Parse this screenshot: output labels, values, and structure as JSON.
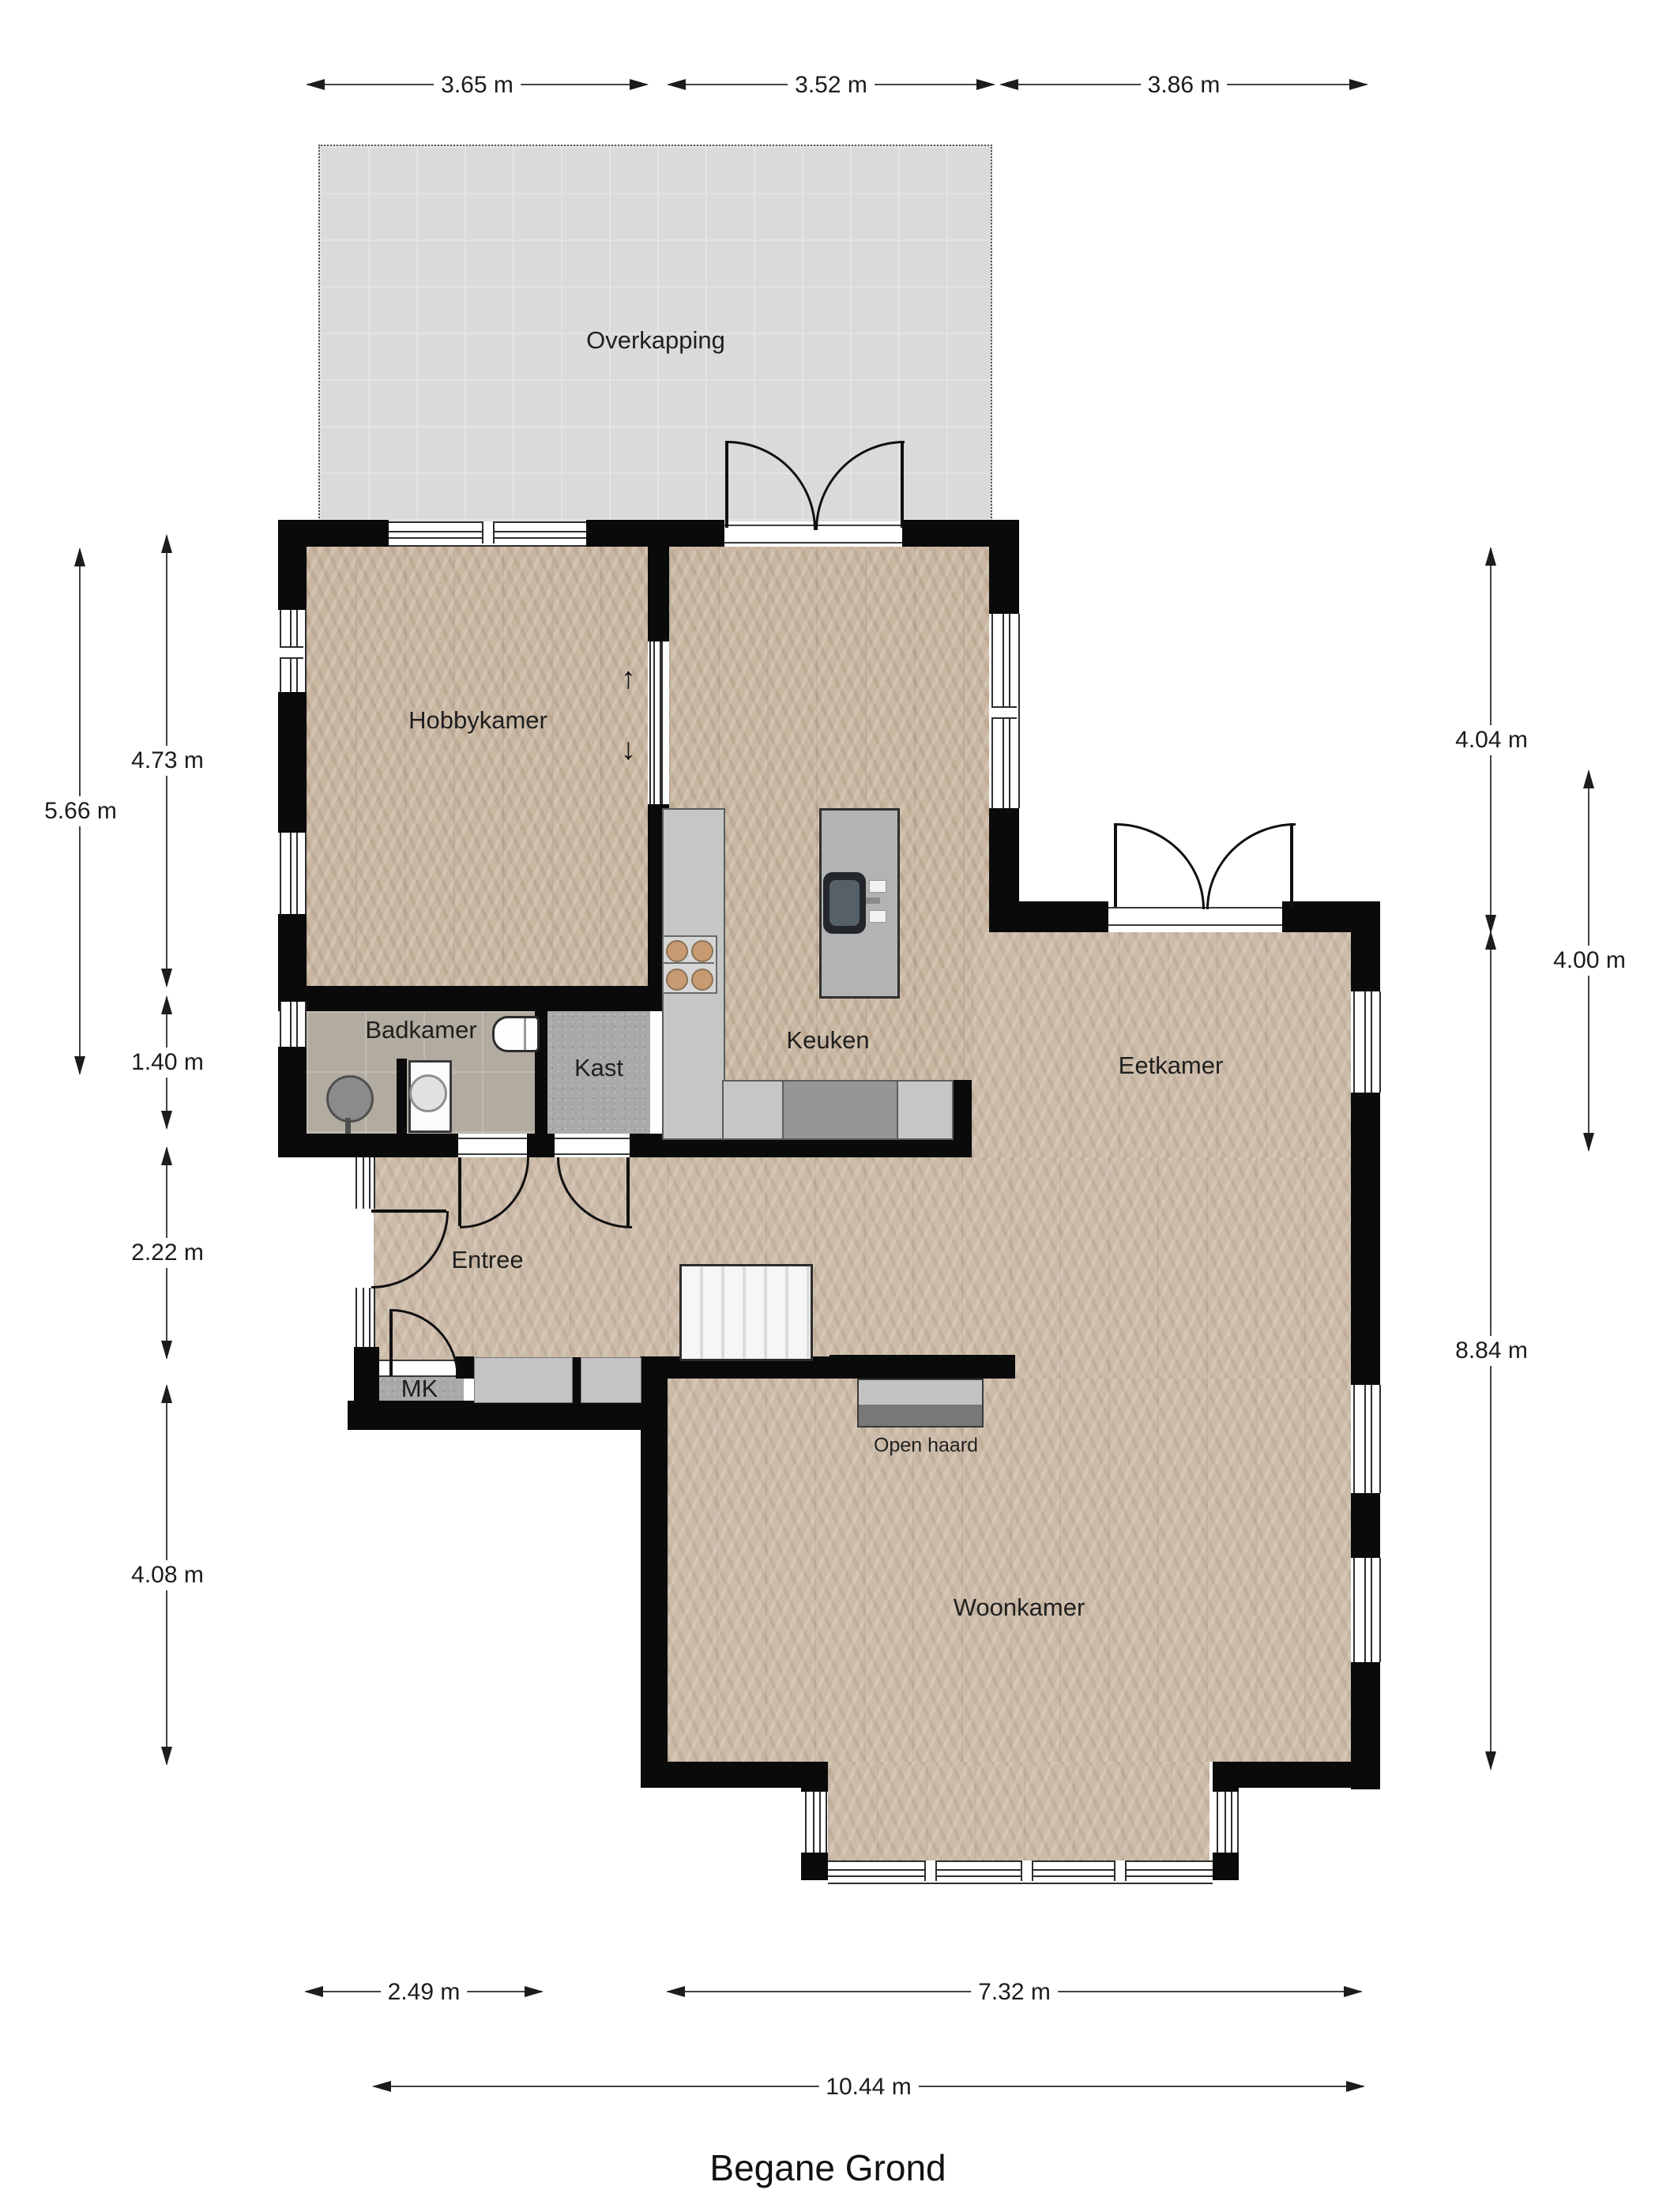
{
  "title": "Begane Grond",
  "rooms": {
    "overkapping": "Overkapping",
    "hobbykamer": "Hobbykamer",
    "badkamer": "Badkamer",
    "kast": "Kast",
    "keuken": "Keuken",
    "eetkamer": "Eetkamer",
    "entree": "Entree",
    "mk": "MK",
    "open_haard": "Open haard",
    "woonkamer": "Woonkamer"
  },
  "dims": {
    "top1": "3.65 m",
    "top2": "3.52 m",
    "top3": "3.86 m",
    "left_total": "5.66 m",
    "left1": "4.73 m",
    "left2": "1.40 m",
    "left3": "2.22 m",
    "left4": "4.08 m",
    "right1": "4.04 m",
    "right2": "8.84 m",
    "right_inner": "4.00 m",
    "bottom1": "2.49 m",
    "bottom2": "7.32 m",
    "bottom_total": "10.44 m"
  },
  "stair_arrows": {
    "up": "↑",
    "down": "↓"
  },
  "colors": {
    "wall": "#0a0a0a",
    "wood_floor": "#c9b7a2",
    "overkapping_floor": "#d9dad9",
    "bathroom_tile": "#b2aba0",
    "closet_floor": "#a9a9a9",
    "counter": "#c6c6c6"
  }
}
